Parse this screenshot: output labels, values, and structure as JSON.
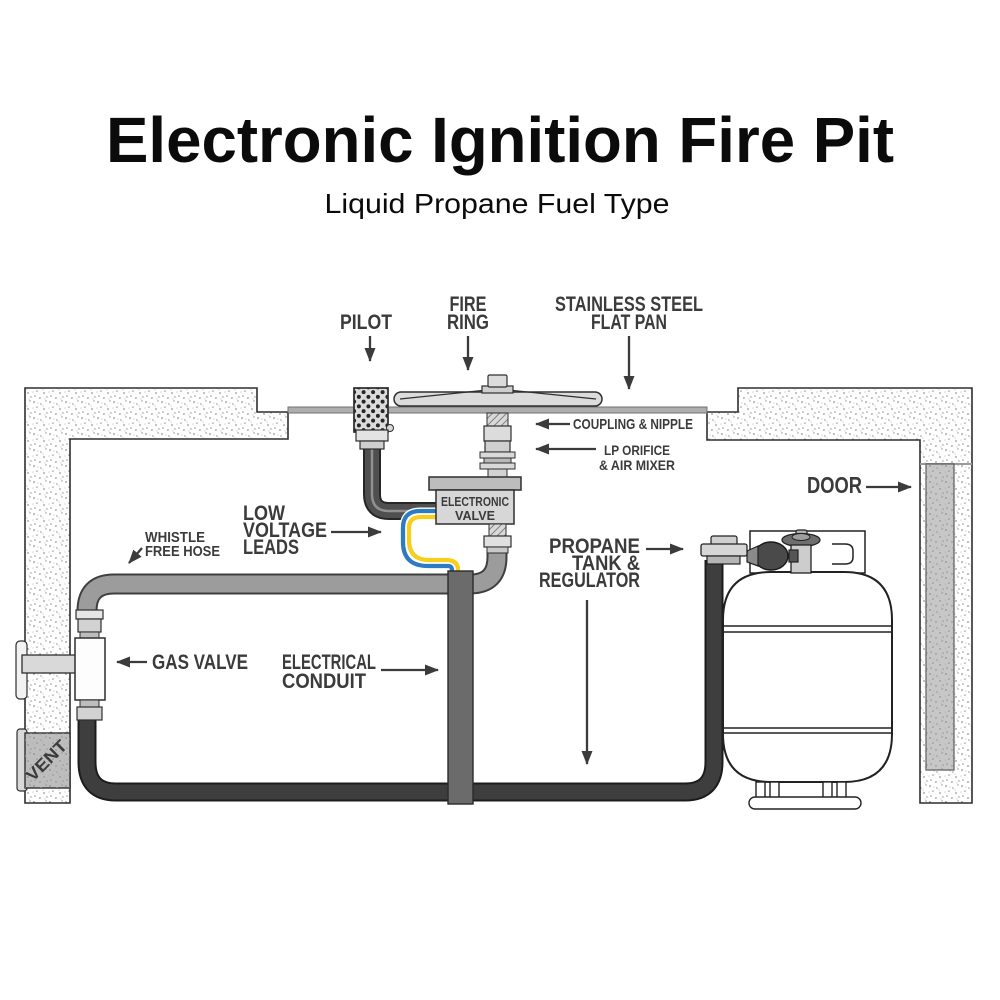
{
  "title": "Electronic Ignition Fire Pit",
  "subtitle": "Liquid Propane Fuel Type",
  "labels": {
    "pilot": "PILOT",
    "fire_ring": {
      "l1": "FIRE",
      "l2": "RING"
    },
    "flat_pan": {
      "l1": "STAINLESS STEEL",
      "l2": "FLAT PAN"
    },
    "coupling_nipple": "COUPLING & NIPPLE",
    "lp_orifice": {
      "l1": "LP ORIFICE",
      "l2": "& AIR MIXER"
    },
    "electronic_valve": {
      "l1": "ELECTRONIC",
      "l2": "VALVE"
    },
    "door": "DOOR",
    "low_voltage_leads": {
      "l1": "LOW",
      "l2": "VOLTAGE",
      "l3": "LEADS"
    },
    "whistle_free_hose": {
      "l1": "WHISTLE",
      "l2": "FREE HOSE"
    },
    "gas_valve": "GAS VALVE",
    "electrical_conduit": {
      "l1": "ELECTRICAL",
      "l2": "CONDUIT"
    },
    "propane_tank": {
      "l1": "PROPANE",
      "l2": "TANK &",
      "l3": "REGULATOR"
    },
    "vent": "VENT"
  },
  "colors": {
    "title_text": "#0b0b0b",
    "label_text": "#3b3b3b",
    "gas_hose_gray": "#9c9c9c",
    "electrical_conduit": "#6b6b6b",
    "black_hose": "#3e3e3e",
    "wire_blue": "#2d7cc1",
    "wire_yellow": "#f6ce1c",
    "valve_body": "#d7d7d7",
    "pan_gray": "#aeaeae",
    "door_panel": "#c7c7c7",
    "vent_panel": "#bdbdbd"
  }
}
